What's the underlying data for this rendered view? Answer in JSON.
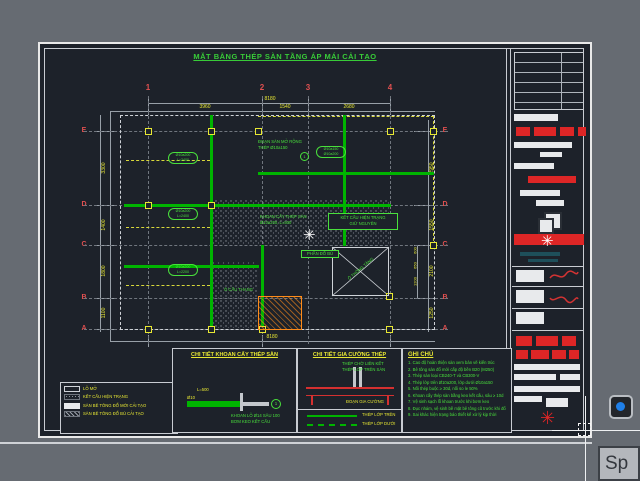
{
  "sheet": {
    "title": "MẶT BẰNG THÉP SÀN TẦNG ÁP MÁI CẢI TẠO",
    "grid": {
      "cols": [
        "1",
        "2",
        "3",
        "4"
      ],
      "rows": [
        "E",
        "D",
        "C",
        "B",
        "A"
      ],
      "bottom_col": "1"
    },
    "dims": {
      "top_total": "8180",
      "top_segments": [
        "3960",
        "1540",
        "2680"
      ],
      "bottom_total": "8180",
      "left_segments": [
        "3300",
        "1400",
        "1800",
        "1100"
      ],
      "right_segments": [
        "2950",
        "1550",
        "2100",
        "1250"
      ],
      "right_subs": [
        "600",
        "650",
        "1200"
      ]
    },
    "tags": [
      {
        "l1": "Ø10a200",
        "l2": "L=2400"
      },
      {
        "l1": "Ø10a200",
        "l2": "L=2400"
      },
      {
        "l1": "Ø10a200",
        "l2": "L=2200"
      },
      {
        "l1": "Ø10a150",
        "l2": "Ø10a200"
      }
    ],
    "annotations": {
      "expansion_l1": "ĐOẠN SÀN MỞ RỘNG",
      "expansion_l2": "THÉP Ø10a150",
      "expansion_mark": "1",
      "drill_l1": "KHOAN CẤY THÉP SÀN",
      "drill_l2": "Ø10a200, L=500",
      "existing_l1": "KẾT CẤU HIỆN TRẠNG",
      "existing_l2": "GIỮ NGUYÊN",
      "patch": "PHẦN ĐỔ BÙ",
      "void_label": "Ô THÔNG TẦNG",
      "stair_label": "Ô CẦU THANG"
    },
    "legend": {
      "items": [
        {
          "label": "LỖ MỞ"
        },
        {
          "label": "KẾT CẤU HIỆN TRẠNG"
        },
        {
          "label": "SÀN BÊ TÔNG ĐỔ MỚI CẢI TẠO"
        },
        {
          "label": "SÀN BÊ TÔNG ĐỔ BÙ CẢI TẠO"
        }
      ]
    },
    "panels": {
      "khoan": {
        "title": "CHI TIẾT KHOAN CẤY THÉP SÀN",
        "bar_label": "Ø10",
        "dim": "L=500",
        "note1": "KHOAN LỖ Ø14 SÂU 100",
        "note2": "BƠM KEO KẾT CẤU",
        "mark": "1"
      },
      "giacuong": {
        "title": "CHI TIẾT GIA CƯỜNG THÉP",
        "note1": "THÉP CHỜ LIÊN KẾT",
        "note2": "THÉP LỚP TRÊN SÀN",
        "note3": "ĐOẠN GIA CƯỜNG",
        "legend_solid": "THÉP LỚP TRÊN",
        "legend_dashed": "THÉP LỚP DƯỚI"
      },
      "ghichu": {
        "title": "GHI CHÚ",
        "items": [
          "1. Cao độ hoàn thiện sàn xem bản vẽ kiến trúc",
          "2. Bê tông sàn đổ mới cấp độ bền B20 (M250)",
          "3. Thép sàn loại CB240-T và CB300-V",
          "4. Thép lớp trên Ø10a200, lớp dưới Ø10a150",
          "5. Nối thép buộc ≥ 30d, nối so le 50%",
          "6. Khoan cấy thép sàn bằng keo kết cấu, sâu ≥ 10d",
          "7. Vệ sinh sạch lỗ khoan trước khi bơm keo",
          "8. Đục nhám, vệ sinh bề mặt bê tông cũ trước khi đổ",
          "9. Sai khác hiện trạng báo thiết kế xử lý kịp thời"
        ]
      }
    }
  },
  "ui": {
    "command_input": "Sp"
  },
  "colors": {
    "beam_green": "#00b400",
    "dim_yellow": "#e8e833",
    "grid_red": "#e05050",
    "note_green": "#49e03c",
    "stamp_red": "#dd2626"
  }
}
